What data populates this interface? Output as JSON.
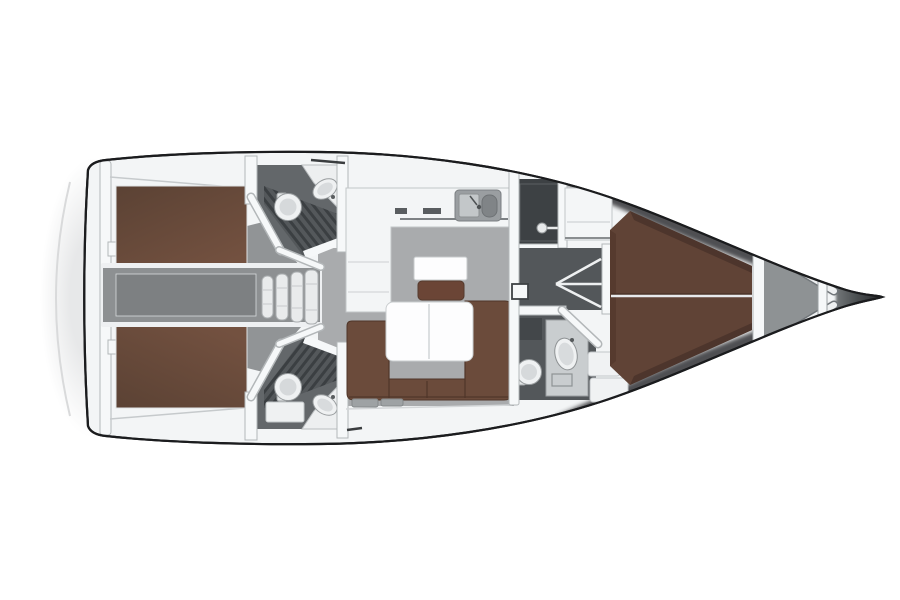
{
  "palette": {
    "background": "#ffffff",
    "hull_outline": "#1b1c1e",
    "deck_white": "#f3f5f6",
    "wall_white": "#f6f8f9",
    "wall_edge": "#b3b7b9",
    "salon_floor": "#a9abad",
    "corridor_gray": "#8d9092",
    "engine_gray": "#7d8082",
    "cabin_floor": "#919496",
    "head_floor": "#63676a",
    "head_floor_dark": "#53575a",
    "shower_dark": "#3d4144",
    "grate_base": "#54585b",
    "grate_stripe": "#3b3f42",
    "berth_dark": "#5b4234",
    "berth_light": "#735140",
    "vberth_brown": "#604336",
    "vberth_edge": "#4a332a",
    "sofa_brown": "#6b4b3b",
    "sofa_seam": "#4f3629",
    "seat_brown": "#6b4536",
    "table_white": "#fdfdfe",
    "fixture_white": "#eff1f2",
    "fixture_edge": "#989c9e",
    "vanity_gray": "#c9cdcf",
    "locker_gray": "#8e9294",
    "bow_dark": "#303336",
    "swim_platform_line": "#d9dadb"
  },
  "layout_regions": [
    "swim-platform",
    "transom",
    "aft-cabin-port",
    "aft-cabin-starboard",
    "engine-corridor",
    "companionway-steps",
    "aft-head-port",
    "aft-head-starboard",
    "galley",
    "chart-table",
    "salon",
    "salon-table",
    "salon-sofa",
    "midship-shower",
    "passageway",
    "forward-head",
    "wardrobe",
    "forward-cabin",
    "v-berth",
    "anchor-locker",
    "bow"
  ],
  "fixtures": {
    "toilets": 3,
    "sinks": 4,
    "shower_compartments": 3,
    "double_berths": 3,
    "companionway_steps": 4,
    "deck_hatches": 2
  }
}
